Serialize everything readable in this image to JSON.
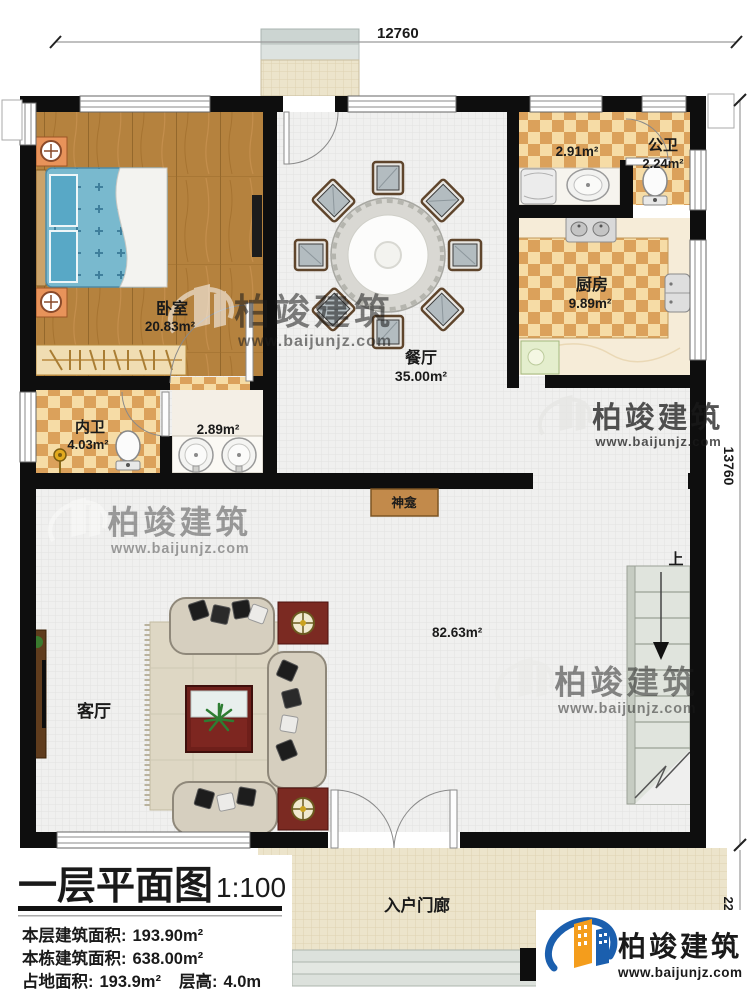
{
  "plan": {
    "rooms": {
      "bedroom": {
        "name": "卧室",
        "area": "20.83m²"
      },
      "dining": {
        "name": "餐厅",
        "area": "35.00m²"
      },
      "kitchen": {
        "name": "厨房",
        "area": "9.89m²"
      },
      "laundry": {
        "area": "2.91m²"
      },
      "public_bath": {
        "name": "公卫",
        "area": "2.24m²"
      },
      "inner_bath": {
        "name": "内卫",
        "area": "4.03m²"
      },
      "vanity": {
        "area": "2.89m²"
      },
      "living": {
        "name": "客厅",
        "area": "82.63m²"
      },
      "shrine": {
        "name": "神龛"
      },
      "entry_porch": {
        "name": "入户门廊"
      },
      "stairs": {
        "direction_label": "上"
      }
    },
    "dimensions": {
      "top": "12760",
      "right": "13760",
      "bottom_right": "2250"
    }
  },
  "title_block": {
    "title": "一层平面图",
    "scale": "1:100",
    "floor_area_label": "本层建筑面积:",
    "floor_area_value": "193.90m²",
    "building_area_label": "本栋建筑面积:",
    "building_area_value": "638.00m²",
    "footprint_label": "占地面积:",
    "footprint_value": "193.9m²",
    "height_label": "层高:",
    "height_value": "4.0m"
  },
  "branding": {
    "company": "柏竣建筑",
    "website": "www.baijunjz.com",
    "brand_blue": "#1b5fae",
    "brand_orange": "#f49d1c"
  }
}
